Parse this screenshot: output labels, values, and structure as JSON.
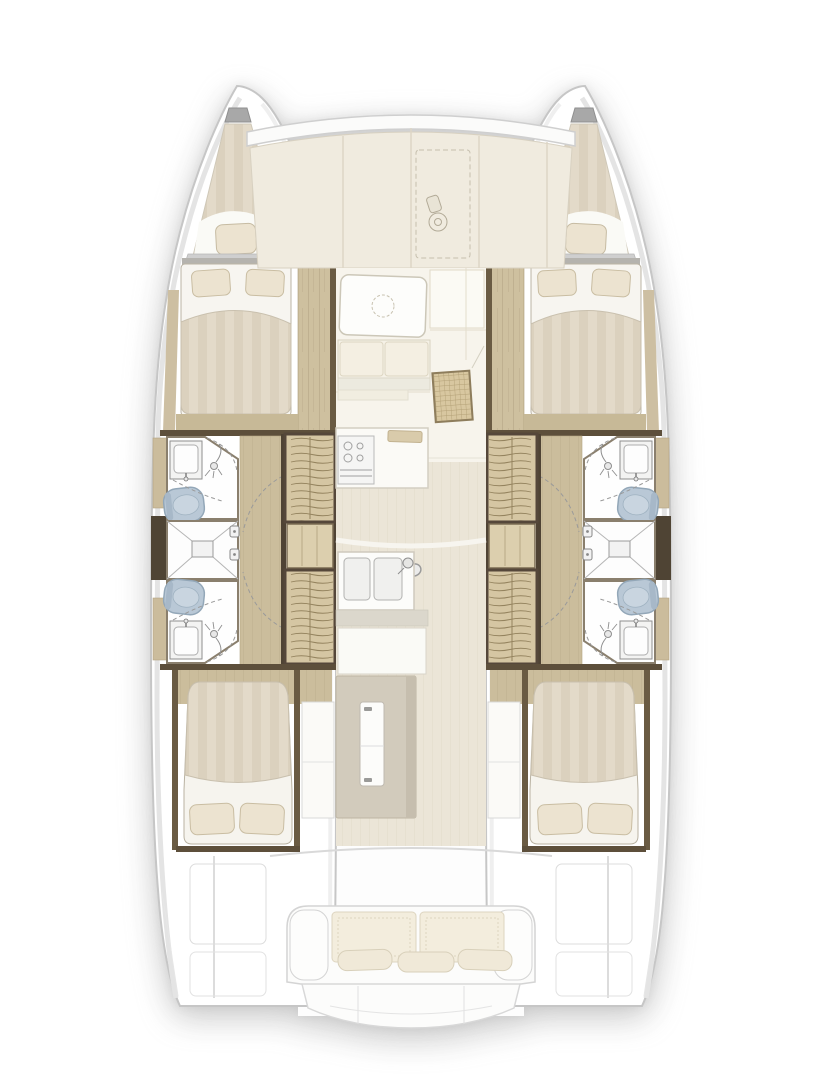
{
  "document": {
    "description": "Top-down interior layout floor plan of a four-cabin sailing catamaran, bow up",
    "view": "top-down",
    "orientation": "bow-up",
    "visible_text": []
  },
  "palette": {
    "background": "#ffffff",
    "hull_outline": "#c6c6c6",
    "deck_cream": "#f0ebdf",
    "wood_floor": "#cbbd9c",
    "wood_plank": "#cec09f",
    "wood_dark_wall": "#5d4f3b",
    "stair_tread": "#d5c6a3",
    "bed_stripe_a": "#e3dac9",
    "bed_stripe_b": "#dbd1be",
    "pillow": "#ece3d0",
    "sheet_white": "#f7f5f0",
    "toilet_blue": "#b9c8d6",
    "cushion_cream": "#f3eddd",
    "island_gray": "#d2cbbc",
    "floor_grain": "#ebe5d7",
    "wicker": "#d8c7a0"
  },
  "vessel": {
    "type": "catamaran-floor-plan",
    "symmetry": "starboard-mirrors-port",
    "regions": {
      "foredeck": {
        "features": [
          "crossbeam-band",
          "deck-panels",
          "dashed-deck-hatch",
          "anchor-windlass"
        ]
      },
      "port_hull": {
        "bow_berth": {
          "pillows": 1,
          "finish": "striped-mattress"
        },
        "forward_cabin": {
          "bed": "double",
          "pillows": 2,
          "walkway": "wood-planks"
        },
        "forward_head": {
          "fixtures": [
            "sink",
            "toilet",
            "shower-head",
            "dashed-door-swings"
          ]
        },
        "central_shower": {
          "shape": "square",
          "marking": "corner-diagonals-center-drain"
        },
        "aft_head": {
          "fixtures": [
            "toilet",
            "sink",
            "shower-head",
            "dashed-door-swings"
          ]
        },
        "companionway": {
          "flights": 2,
          "landing": true
        },
        "passage": {
          "floor": "wood",
          "door_swings": 2,
          "latch_plates": 2
        },
        "aft_cabin": {
          "bed": "double",
          "pillows": 2,
          "cabinet": true
        },
        "stern": {
          "panels": 2
        }
      },
      "starboard_hull": {
        "mirror_of": "port_hull"
      },
      "saloon": {
        "features": [
          "dinette-table-dashed-circle",
          "bench-seat-4-cushions",
          "wicker-chart-seat",
          "side-panels"
        ]
      },
      "galley": {
        "features": [
          "stove-counter",
          "cutting-board",
          "double-sink",
          "faucet",
          "door-handle",
          "island-cabinet",
          "fridge-door"
        ]
      },
      "cockpit": {
        "features": [
          "curved-coaming",
          "bench-2-seat-cushions",
          "3-pillows",
          "armrests",
          "swim-steps",
          "transom-panels"
        ]
      }
    }
  }
}
